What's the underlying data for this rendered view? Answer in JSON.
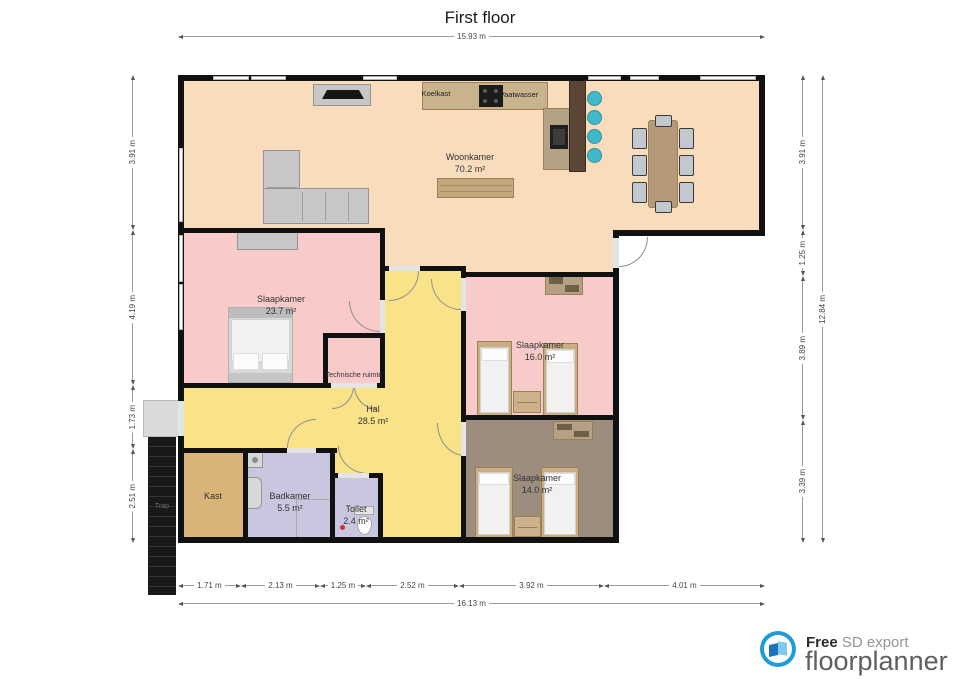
{
  "title": "First floor",
  "dims": {
    "top_total": "15.93 m",
    "bottom": [
      "1.71 m",
      "2.13 m",
      "1.25 m",
      "2.52 m",
      "3.92 m",
      "4.01 m"
    ],
    "bottom_total": "16.13 m",
    "left": [
      "3.91 m",
      "4.19 m",
      "1.73 m",
      "2.51 m"
    ],
    "right": [
      "3.91 m",
      "1.25 m",
      "3.89 m",
      "3.39 m"
    ],
    "right_total": "12.84 m"
  },
  "rooms": {
    "woonkamer": {
      "name": "Woonkamer",
      "area": "70.2 m²"
    },
    "slaapkamer1": {
      "name": "Slaapkamer",
      "area": "23.7 m²"
    },
    "slaapkamer2": {
      "name": "Slaapkamer",
      "area": "16.0 m²"
    },
    "slaapkamer3": {
      "name": "Slaapkamer",
      "area": "14.0 m²"
    },
    "hal": {
      "name": "Hal",
      "area": "28.5 m²"
    },
    "badkamer": {
      "name": "Badkamer",
      "area": "5.5 m²"
    },
    "toilet": {
      "name": "Toilet",
      "area": "2.4 m²"
    },
    "technische_ruimte": {
      "name": "Technische ruimte"
    },
    "kast": {
      "name": "Kast"
    },
    "trap": {
      "name": "Trap"
    }
  },
  "appliances": {
    "koelkast": "Koelkast",
    "vaatwasser": "Vaatwasser"
  },
  "footer": {
    "free": "Free",
    "export": " SD export",
    "brand": "floorplanner"
  },
  "colors": {
    "woonkamer": "#f8dcbc",
    "slaapkamer": "#f8caca",
    "hal": "#fae289",
    "slaapkamer3": "#9d8d7f",
    "kast": "#d9b478",
    "badkamer": "#c8c7df",
    "wall": "#111111",
    "bar_stool": "#41b9c9",
    "bar_counter": "#5b4635",
    "logo_blue": "#1e9cd7"
  }
}
